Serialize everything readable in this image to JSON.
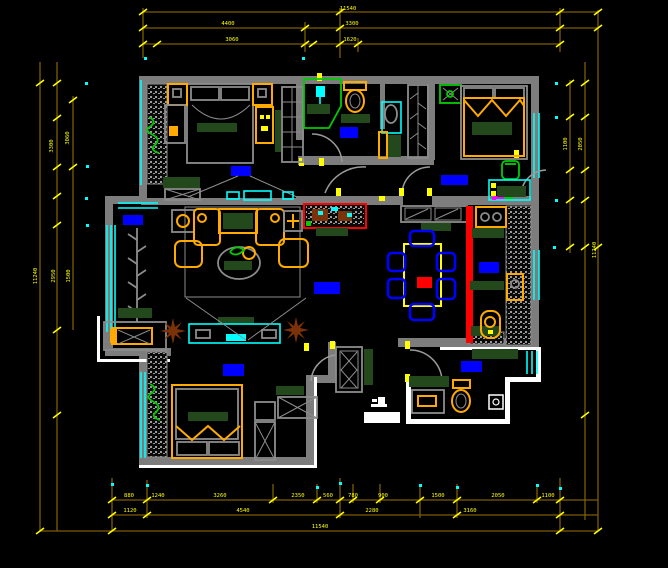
{
  "drawing": {
    "kind": "residential apartment floor plan (CAD)",
    "background": "#000000"
  },
  "colors": {
    "dimension_line": "#7d5e00",
    "dimension_text": "#ffff00",
    "wall_gray": "#7d7d7d",
    "wall_white": "#ffffff",
    "window_cyan": "#00ffff",
    "furniture_orange": "#ffaa00",
    "soft_furnishing_green": "#23481c",
    "fixture_green": "#00cc00",
    "room_label_blue": "#0000ff",
    "feature_wall_red": "#ff0000",
    "plant_brown": "#7c3208",
    "chair_blue": "#0000ff",
    "marker_magenta": "#ff00ff"
  },
  "dims": {
    "top": {
      "total": "11540",
      "row2": [
        "4400",
        "3300"
      ],
      "row3": [
        "3060",
        "1620"
      ]
    },
    "left": {
      "total": "11240",
      "upper": [
        "3300",
        "3060"
      ],
      "lower": [
        "2950",
        "1500"
      ]
    },
    "right": {
      "inner": "1100",
      "mid": "2050",
      "total": "11240"
    },
    "bottom": {
      "row1": [
        "880",
        "1240",
        "3260",
        "2350",
        "560",
        "780",
        "900",
        "1500",
        "2050",
        "1100"
      ],
      "row2": [
        "1120",
        "4540",
        "2280",
        "3160"
      ],
      "total": "11540"
    }
  }
}
